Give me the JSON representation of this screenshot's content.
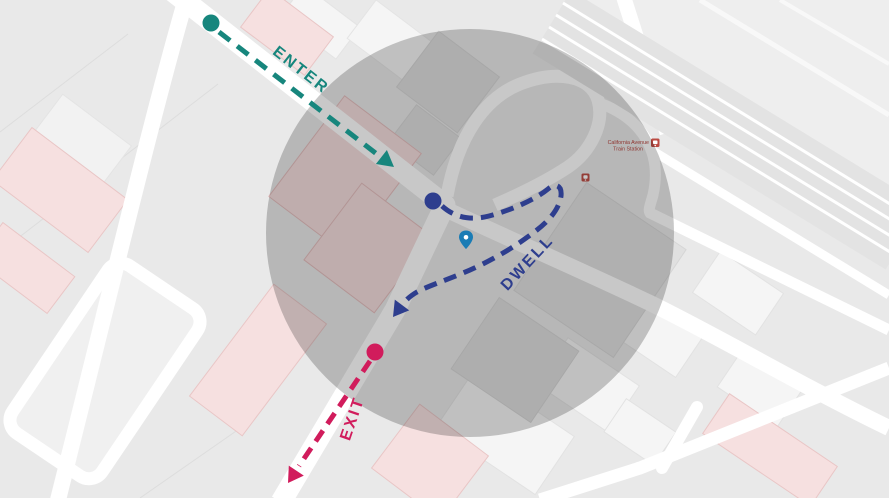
{
  "labels": {
    "enter": "ENTER",
    "dwell": "DWELL",
    "exit": "EXIT"
  },
  "poi": {
    "station_name_line1": "California Avenue",
    "station_name_line2": "Train Station"
  },
  "icons": {
    "station_icon": "transit-station-icon",
    "poi_icon": "transit-station-icon",
    "pin_icon": "location-pin-icon"
  },
  "colors": {
    "enter": "#17867D",
    "dwell": "#2E3E8E",
    "exit": "#D11C5C",
    "geofence": "#141414",
    "pin": "#1A7CB5",
    "poi_red": "#B5403A"
  }
}
